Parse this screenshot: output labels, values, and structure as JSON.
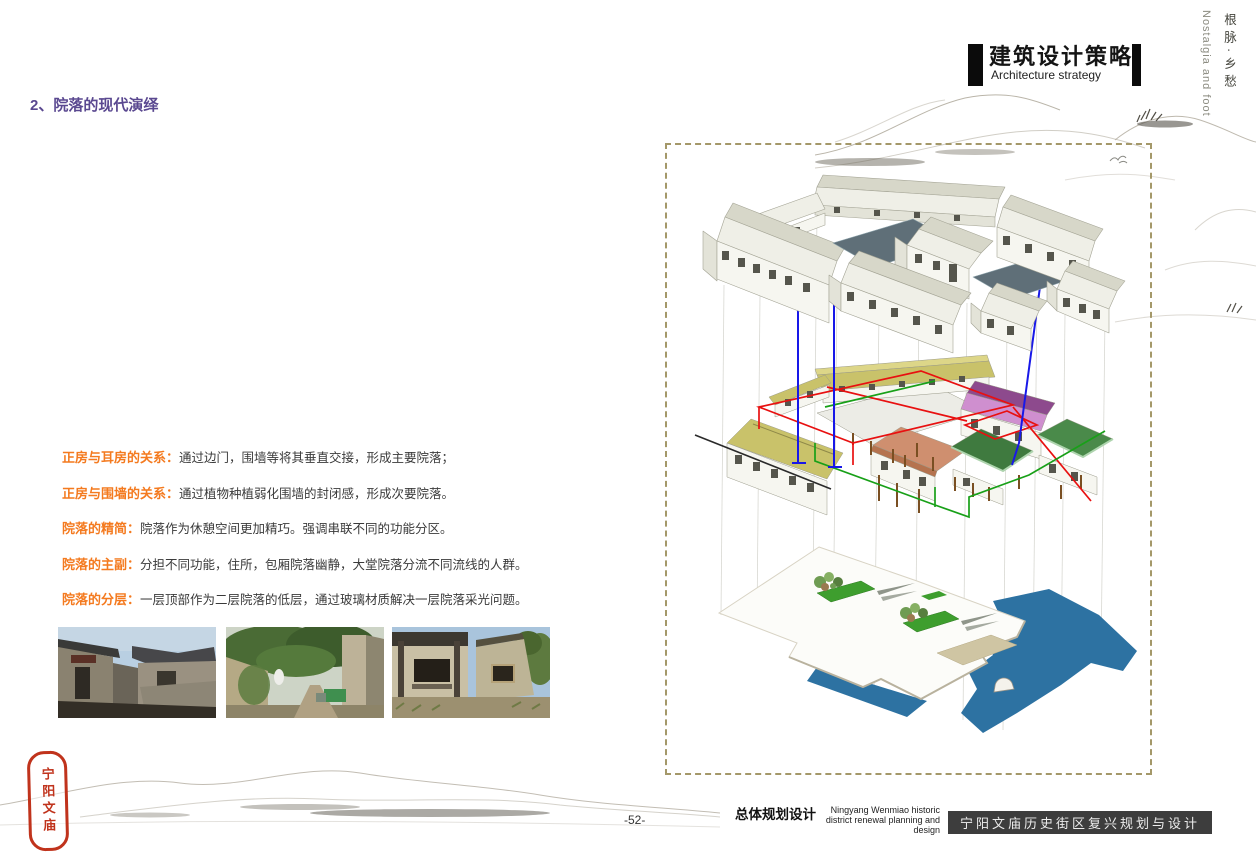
{
  "page": {
    "title": "2、院落的现代演绎"
  },
  "header": {
    "title_cn": "建筑设计策略",
    "title_en": "Architecture strategy",
    "corner_cn": "根脉·乡愁",
    "corner_en": "Nostalgia and foot"
  },
  "notes": [
    {
      "label": "正房与耳房的关系：",
      "text": "通过边门，围墙等将其垂直交接，形成主要院落；"
    },
    {
      "label": "正房与围墙的关系：",
      "text": "通过植物种植弱化围墙的封闭感，形成次要院落。"
    },
    {
      "label": "院落的精简：",
      "text": "院落作为休憩空间更加精巧。强调串联不同的功能分区。"
    },
    {
      "label": "院落的主副：",
      "text": "分担不同功能，住所，包厢院落幽静，大堂院落分流不同流线的人群。"
    },
    {
      "label": "院落的分层：",
      "text": "一层顶部作为二层院落的低层，通过玻璃材质解决一层院落采光问题。"
    }
  ],
  "photos": [
    {
      "alt": "旧院落现状照片一"
    },
    {
      "alt": "旧院落现状照片二"
    },
    {
      "alt": "旧院落现状照片三"
    }
  ],
  "seal": {
    "text": "宁阳文庙"
  },
  "footer": {
    "page_number": "-52-",
    "series_cn": "总体规划设计",
    "series_en_line1": "Ningyang Wenmiao historic",
    "series_en_line2": "district renewal planning and design",
    "banner": "宁阳文庙历史街区复兴规划与设计"
  },
  "colors": {
    "accent_purple": "#5a4890",
    "accent_orange": "#f47a1f",
    "banner_bg": "#3d3d3d",
    "dashed_border": "#a49869",
    "blue_guide": "#1818e8",
    "red_overlay": "#e81010",
    "green_overlay": "#18a018",
    "water_blue": "#2d72a2",
    "roof_olive": "#c9c26a",
    "roof_purple": "#cf8fcf",
    "roof_green": "#3f7a3f",
    "roof_salmon": "#cf8f6f"
  }
}
